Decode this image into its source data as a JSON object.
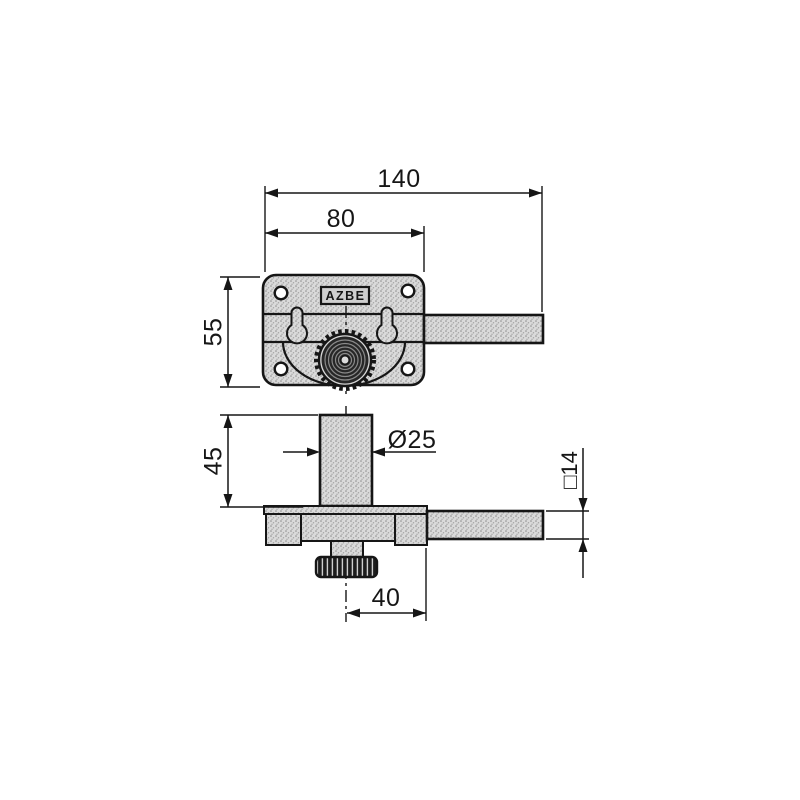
{
  "brand_label": "AZBE",
  "dimensions": {
    "total_length": "140",
    "body_width": "80",
    "body_height": "55",
    "cylinder_height": "45",
    "cylinder_diameter": "Ø25",
    "bolt_section": "□14",
    "knob_offset": "40"
  },
  "colors": {
    "line": "#161616",
    "metal_fill": "#dadada",
    "background": "#ffffff"
  }
}
